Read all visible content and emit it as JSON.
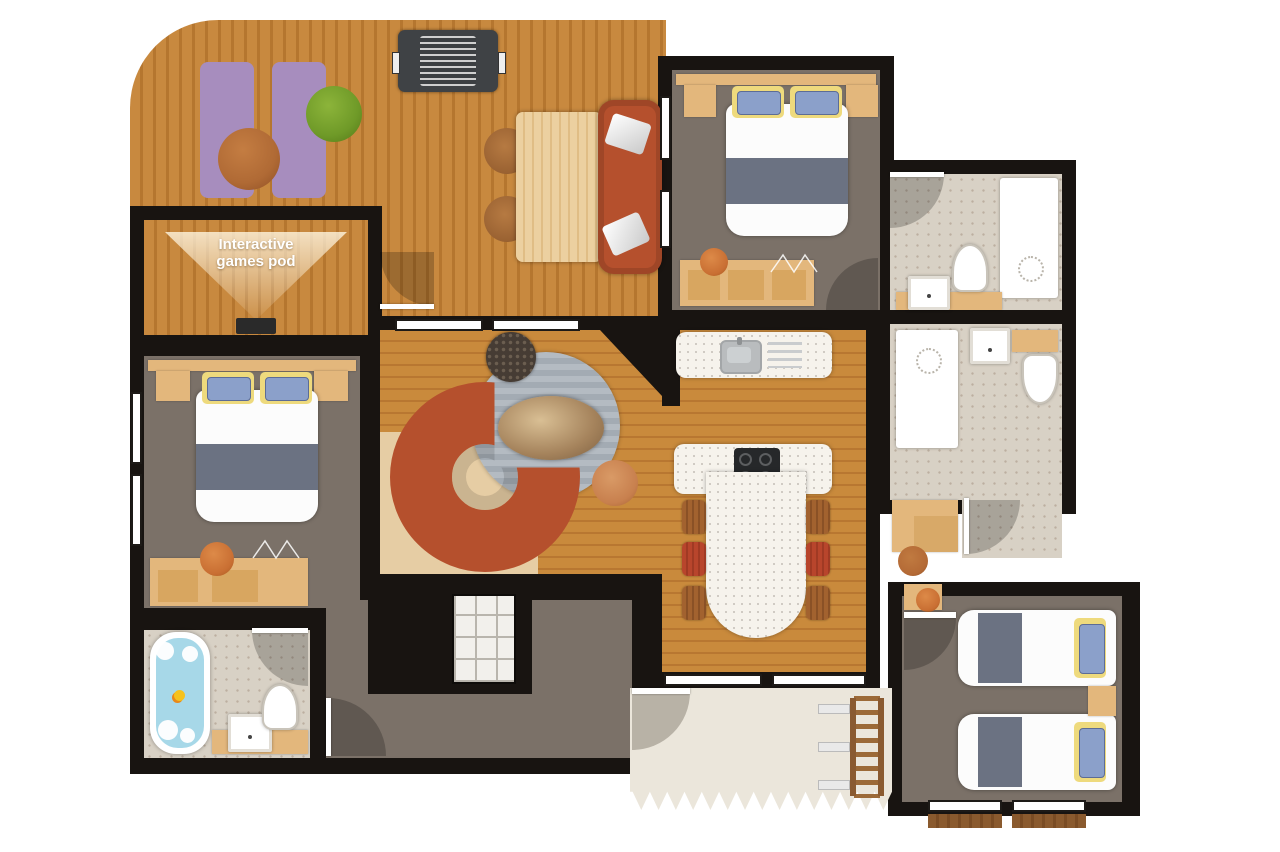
{
  "labels": {
    "games_pod": {
      "line1": "Interactive",
      "line2": "games pod"
    }
  },
  "palette": {
    "wall": "#181411",
    "deck": "#c8893f",
    "deck_stripe": "#b5762f",
    "wood_floor": "#c98a3c",
    "wood_floor_stripe": "#b87731",
    "room_gray": "#7b7168",
    "stone": "#d8d1c5",
    "stone_speck": "#bcafa0",
    "counter": "#f6f3ec",
    "furn_wood": "#e3b77c",
    "sofa_red": "#b5502d",
    "mat_purple": "#a78dbe",
    "rug_gray": "#aeb6bd",
    "patio": "#ebe6db",
    "water": "#a7d8e8",
    "pillow_blue": "#8ba0ca",
    "pillow_yellow": "#eeda7d",
    "linen": "#fcfcfc",
    "blanket": "#6b7282",
    "accent_orange": "#c96f33",
    "bean_green": "#6f9a28",
    "bean_brown": "#b06a35",
    "bbq_dark": "#3f4245"
  }
}
